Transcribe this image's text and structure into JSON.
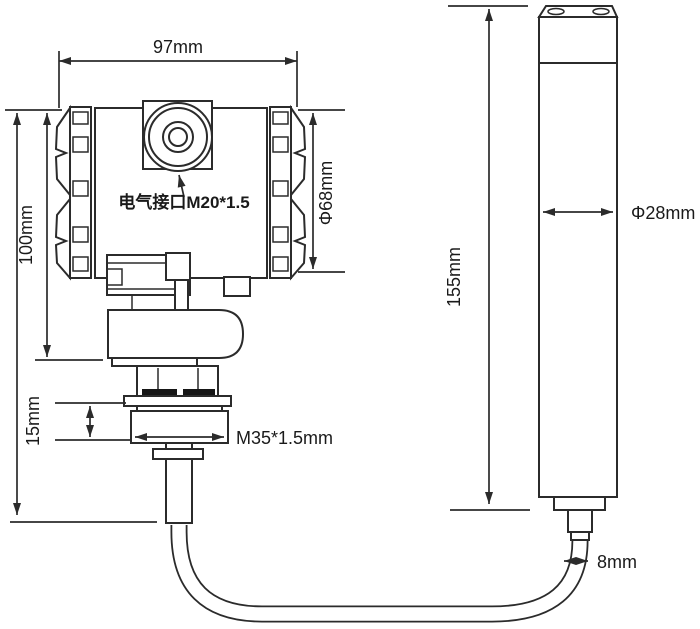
{
  "colors": {
    "background": "#ffffff",
    "line": "#2b2b2b",
    "text": "#1a1a1a",
    "seal": "#161616"
  },
  "labels": {
    "housing_width": "97mm",
    "housing_height": "100mm",
    "housing_diameter": "Φ68mm",
    "electrical_port": "电气接口M20*1.5",
    "gland_height": "15mm",
    "thread_spec": "M35*1.5mm",
    "probe_length": "155mm",
    "probe_diameter": "Φ28mm",
    "cable_diameter": "8mm"
  }
}
